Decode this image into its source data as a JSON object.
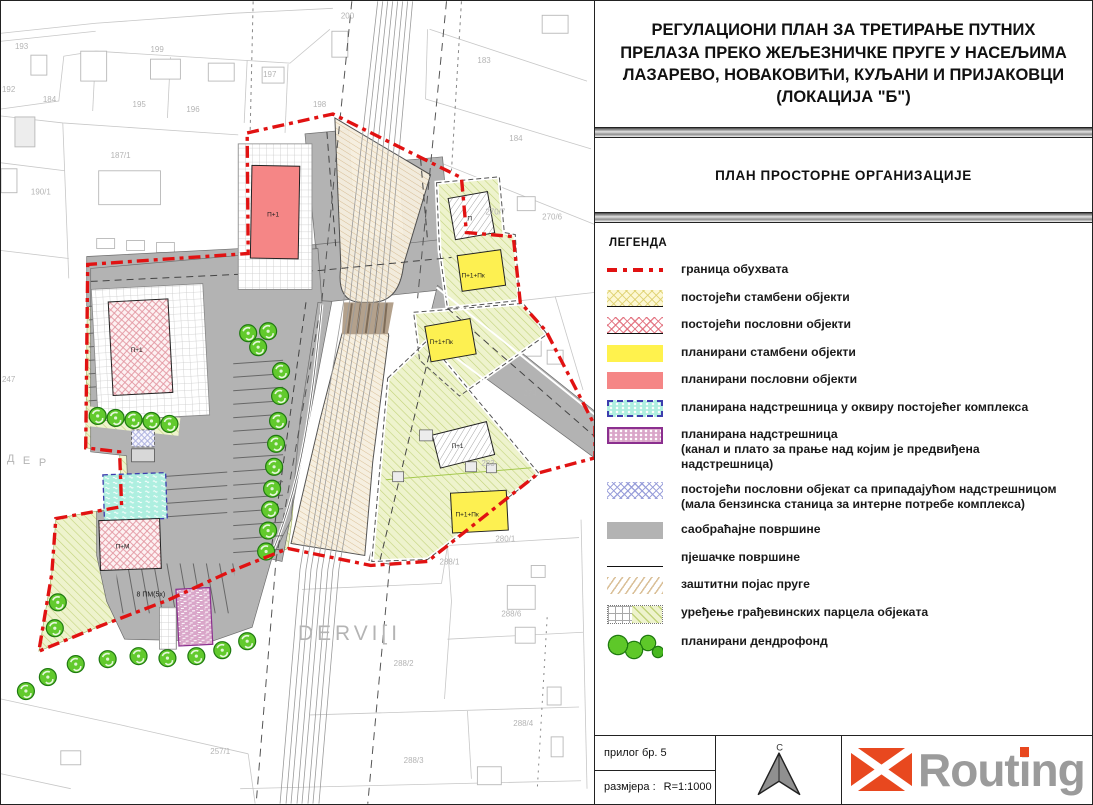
{
  "title": {
    "lines": [
      "РЕГУЛАЦИОНИ ПЛАН ЗА ТРЕТИРАЊЕ ПУТНИХ",
      "ПРЕЛАЗА ПРЕКО ЖЕЉЕЗНИЧКЕ ПРУГЕ У НАСЕЉИМА",
      "ЛАЗАРЕВО, НОВАКОВИЋИ, КУЉАНИ И ПРИЈАКОВЦИ",
      "(ЛОКАЦИЈА \"Б\")"
    ]
  },
  "subtitle": "ПЛАН ПРОСТОРНЕ ОРГАНИЗАЦИЈЕ",
  "legend": {
    "heading": "ЛЕГЕНДА",
    "items": [
      {
        "swatch": "boundary",
        "label": "граница обухвата"
      },
      {
        "swatch": "existing-residential",
        "label": "постојећи стамбени објекти"
      },
      {
        "swatch": "existing-business",
        "label": "постојећи пословни објекти"
      },
      {
        "swatch": "planned-residential",
        "label": "планирани стамбени објекти"
      },
      {
        "swatch": "planned-business",
        "label": "планирани пословни објекти"
      },
      {
        "swatch": "planned-canopy-complex",
        "label": "планирана надстрешница у оквиру постојећег комплекса"
      },
      {
        "swatch": "planned-canopy",
        "label": "планирана надстрешница\n(канал и плато за прање над којим је предвиђена\nнадстрешница)"
      },
      {
        "swatch": "existing-business-canopy",
        "label": "постојећи пословни објекат са припадајућом надстрешницом\n(мала бензинска станица за интерне потребе комплекса)"
      },
      {
        "swatch": "traffic",
        "label": "саобраћајне површине"
      },
      {
        "swatch": "pedestrian",
        "label": "пјешачке површине"
      },
      {
        "swatch": "railway-belt",
        "label": "заштитни појас пруге"
      },
      {
        "swatch": "parcel-arrangement",
        "label": "уређење грађевинских парцела објеката"
      },
      {
        "swatch": "dendrofond",
        "label": "планирани дендрофонд"
      }
    ]
  },
  "footer": {
    "attachment": "прилог бр. 5",
    "scale_label": "размјера :",
    "scale_value": "R=1:1000",
    "north_label": "С"
  },
  "logo": {
    "pre": "Rout",
    "i": "i",
    "post": "ng"
  },
  "colors": {
    "boundary_red": "#e11212",
    "planned_residential_yellow": "#fff24d",
    "planned_business_red": "#f58686",
    "traffic_gray": "#b3b3b3",
    "canopy_cyan": "#aeefe0",
    "canopy_purple": "#d9a6c9",
    "dendro_green": "#5ec829",
    "logo_orange": "#e8481f",
    "logo_gray": "#9b9b9b"
  },
  "map": {
    "cadastral_labels": [
      {
        "t": "193",
        "x": 14,
        "y": 48
      },
      {
        "t": "192",
        "x": 1,
        "y": 91
      },
      {
        "t": "184",
        "x": 42,
        "y": 101
      },
      {
        "t": "199",
        "x": 150,
        "y": 51
      },
      {
        "t": "195",
        "x": 132,
        "y": 106
      },
      {
        "t": "196",
        "x": 186,
        "y": 111
      },
      {
        "t": "197",
        "x": 263,
        "y": 76
      },
      {
        "t": "200",
        "x": 341,
        "y": 17
      },
      {
        "t": "198",
        "x": 313,
        "y": 106
      },
      {
        "t": "183",
        "x": 478,
        "y": 62
      },
      {
        "t": "184",
        "x": 510,
        "y": 140
      },
      {
        "t": "270/7",
        "x": 486,
        "y": 214
      },
      {
        "t": "270/6",
        "x": 543,
        "y": 219
      },
      {
        "t": "187/1",
        "x": 110,
        "y": 157
      },
      {
        "t": "190/1",
        "x": 30,
        "y": 194
      },
      {
        "t": "247",
        "x": 1,
        "y": 382
      },
      {
        "t": "274",
        "x": 524,
        "y": 396
      },
      {
        "t": "283",
        "x": 482,
        "y": 466
      },
      {
        "t": "280/1",
        "x": 496,
        "y": 542
      },
      {
        "t": "288/1",
        "x": 440,
        "y": 565
      },
      {
        "t": "288/6",
        "x": 502,
        "y": 617
      },
      {
        "t": "288/2",
        "x": 394,
        "y": 667
      },
      {
        "t": "288/4",
        "x": 514,
        "y": 727
      },
      {
        "t": "288/3",
        "x": 404,
        "y": 764
      },
      {
        "t": "257/1",
        "x": 210,
        "y": 755
      },
      {
        "t": "Д",
        "x": 6,
        "y": 462,
        "s": 11
      },
      {
        "t": "Е",
        "x": 22,
        "y": 464,
        "s": 11
      },
      {
        "t": "Р",
        "x": 38,
        "y": 466,
        "s": 11
      },
      {
        "t": "DERVI[I",
        "x": 298,
        "y": 641,
        "s": 21,
        "ls": 4
      }
    ],
    "plan_labels": [
      {
        "t": "П+1",
        "x": 267,
        "y": 216
      },
      {
        "t": "П+1",
        "x": 130,
        "y": 352
      },
      {
        "t": "П+М",
        "x": 115,
        "y": 549
      },
      {
        "t": "П",
        "x": 468,
        "y": 220
      },
      {
        "t": "П+1+Пк",
        "x": 462,
        "y": 277
      },
      {
        "t": "П+1+Пк",
        "x": 430,
        "y": 344
      },
      {
        "t": "П+1",
        "x": 452,
        "y": 448
      },
      {
        "t": "П+1+Пк",
        "x": 456,
        "y": 517
      },
      {
        "t": "8 ПМ(5x)",
        "x": 136,
        "y": 597,
        "s": 7
      }
    ],
    "trees": [
      [
        97,
        416
      ],
      [
        115,
        418
      ],
      [
        133,
        420
      ],
      [
        151,
        421
      ],
      [
        169,
        424
      ],
      [
        248,
        333
      ],
      [
        268,
        331
      ],
      [
        258,
        347
      ],
      [
        281,
        371
      ],
      [
        280,
        396
      ],
      [
        278,
        421
      ],
      [
        276,
        444
      ],
      [
        274,
        467
      ],
      [
        272,
        489
      ],
      [
        270,
        510
      ],
      [
        268,
        531
      ],
      [
        266,
        552
      ],
      [
        57,
        603
      ],
      [
        54,
        629
      ],
      [
        25,
        692
      ],
      [
        47,
        678
      ],
      [
        75,
        665
      ],
      [
        107,
        660
      ],
      [
        138,
        657
      ],
      [
        167,
        659
      ],
      [
        196,
        657
      ],
      [
        222,
        651
      ],
      [
        247,
        642
      ]
    ]
  }
}
